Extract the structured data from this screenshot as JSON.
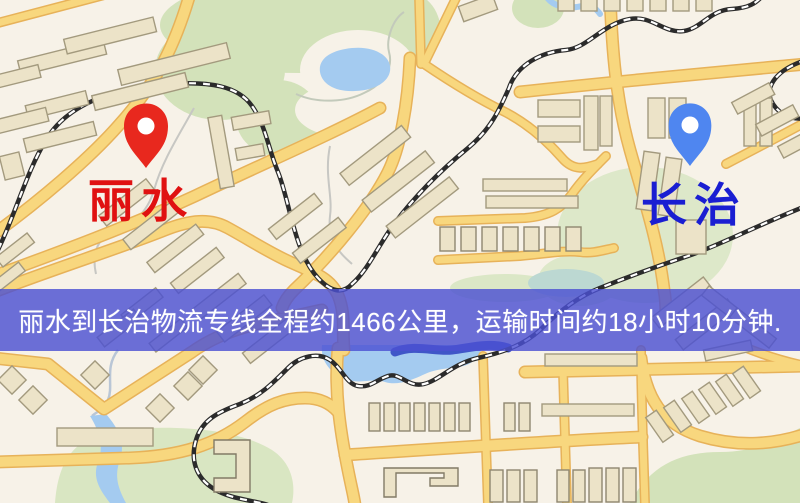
{
  "pins": {
    "origin": {
      "name": "丽水",
      "pin_color": "#e8281e",
      "label_color": "#e01111"
    },
    "destination": {
      "name": "长治",
      "pin_color": "#4f86f0",
      "label_color": "#1a1ed2"
    }
  },
  "banner": {
    "text": "丽水到长治物流专线全程约1466公里，运输时间约18小时10分钟.",
    "background_color": "#4c50d2",
    "text_color": "#ffffff"
  },
  "map": {
    "land_color": "#f7f2e8",
    "park_color": "#d3e2ba",
    "water_color": "#a4cbf0",
    "road_color": "#f8d77e",
    "road_casing_color": "#e7b259",
    "building_color": "#ece3c8",
    "railway_color": "#2b2b2b"
  }
}
